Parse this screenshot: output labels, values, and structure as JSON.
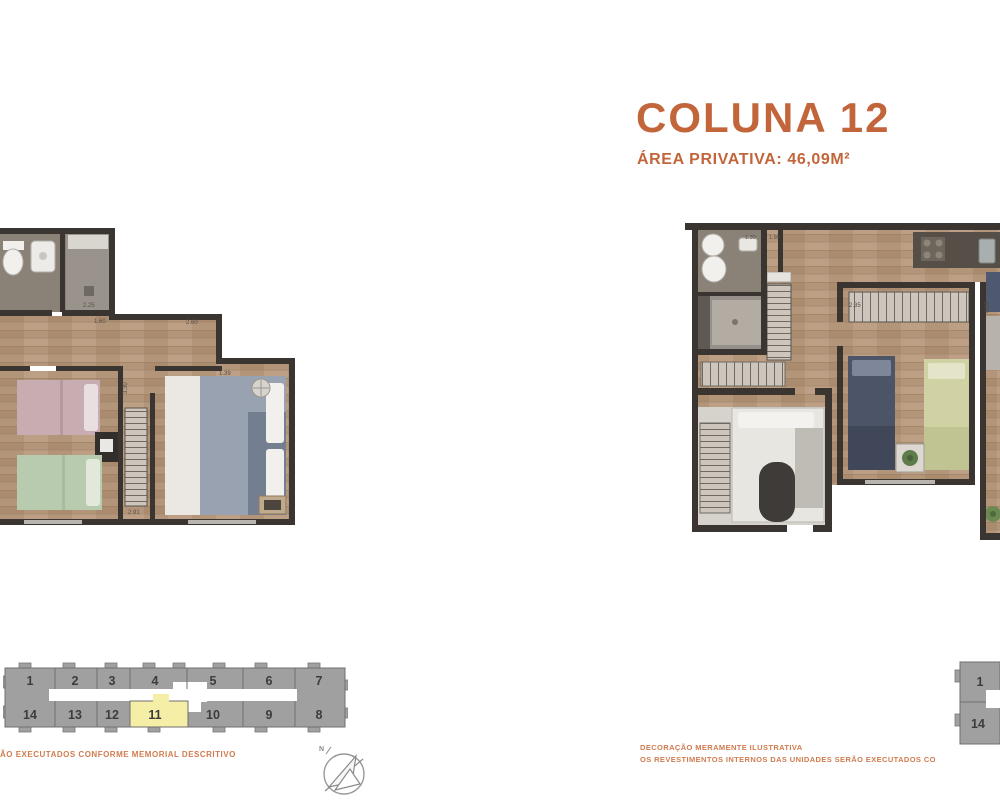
{
  "page": {
    "title": "COLUNA 12",
    "subtitle": "ÁREA PRIVATIVA: 46,09M²",
    "accent_color": "#c2653b"
  },
  "disclaimers": {
    "left": "ÃO EXECUTADOS CONFORME MEMORIAL DESCRITIVO",
    "right_line1": "DECORAÇÃO MERAMENTE ILUSTRATIVA",
    "right_line2": "OS REVESTIMENTOS INTERNOS DAS UNIDADES SERÃO EXECUTADOS CO"
  },
  "left_plan": {
    "dims": {
      "bath": "2.25",
      "hall": "1.60",
      "living": "2.60",
      "bedroom": "1.39",
      "closet": "2.91",
      "hall_vertical": "3.30"
    }
  },
  "right_plan": {
    "dims": {
      "bath_left": "1.30",
      "bath_right": "1.90",
      "bedroom": "2.35",
      "living_vertical": "4.05"
    }
  },
  "key_plan": {
    "top_row": [
      "1",
      "2",
      "3",
      "4",
      "5",
      "6",
      "7"
    ],
    "bottom_row": [
      "14",
      "13",
      "12",
      "11",
      "10",
      "9",
      "8"
    ],
    "highlighted_unit": "11",
    "highlight_color": "#f4eea6"
  },
  "key_plan_right": {
    "units": [
      "1",
      "14"
    ]
  },
  "compass": {
    "label": "N"
  },
  "palette": {
    "wall": "#3a3531",
    "wood": "#b3957a",
    "bath_floor": "#8a8177",
    "key_gray": "#a0a0a0"
  }
}
